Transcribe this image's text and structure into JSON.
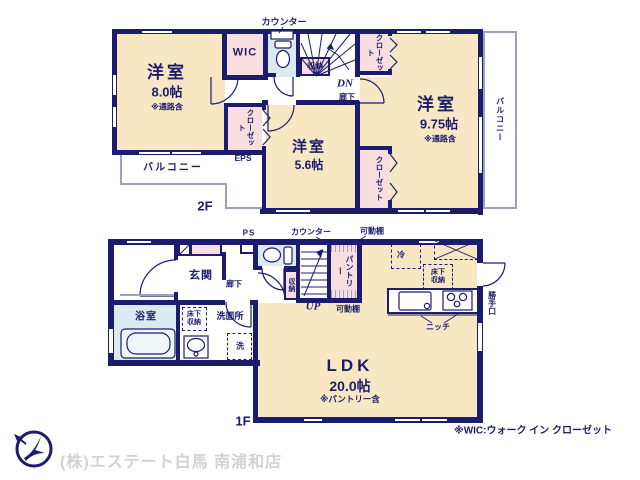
{
  "colors": {
    "wall": "#1c1c6e",
    "room_fill": "#f7e8c3",
    "closet_fill": "#f8dede",
    "wet_area_fill": "#d9eaf0",
    "balcony_outline": "#9aa3b8",
    "company_text": "#d2d2d2"
  },
  "floor2": {
    "floor_label": "2F",
    "counter": "カウンター",
    "room_8": {
      "name": "洋室",
      "size": "8.0帖",
      "note": "※通路含"
    },
    "wic": "WIC",
    "closet_top": "クローゼット",
    "storage": "収納",
    "dn": "DN",
    "hallway": "廊下",
    "room_975": {
      "name": "洋室",
      "size": "9.75帖",
      "note": "※通路含"
    },
    "room_56": {
      "name": "洋室",
      "size": "5.6帖"
    },
    "closet_west": "クローゼット",
    "eps": "EPS",
    "closet_east": "クローゼット",
    "balcony_left": "バルコニー",
    "balcony_right": "バルコニー"
  },
  "floor1": {
    "floor_label": "1F",
    "ps": "PS",
    "counter": "カウンター",
    "shelf_top": "可動棚",
    "shelf_bottom": "可動棚",
    "entrance": "玄関",
    "hallway": "廊下",
    "storage": "収納",
    "up": "UP",
    "pantry": "パントリー",
    "fridge": "冷",
    "underfloor_kitchen": "床下収納",
    "underfloor_wash": "床下収納",
    "bathroom": "浴室",
    "washroom": "洗面所",
    "washer": "洗",
    "niche": "ニッチ",
    "back_door": "勝手口",
    "ldk": {
      "name": "LDK",
      "size": "20.0帖",
      "note": "※パントリー含"
    }
  },
  "footer": {
    "wic_note": "※WIC:ウォーク イン クローゼット",
    "company": "(株)エステート白馬 南浦和店"
  }
}
